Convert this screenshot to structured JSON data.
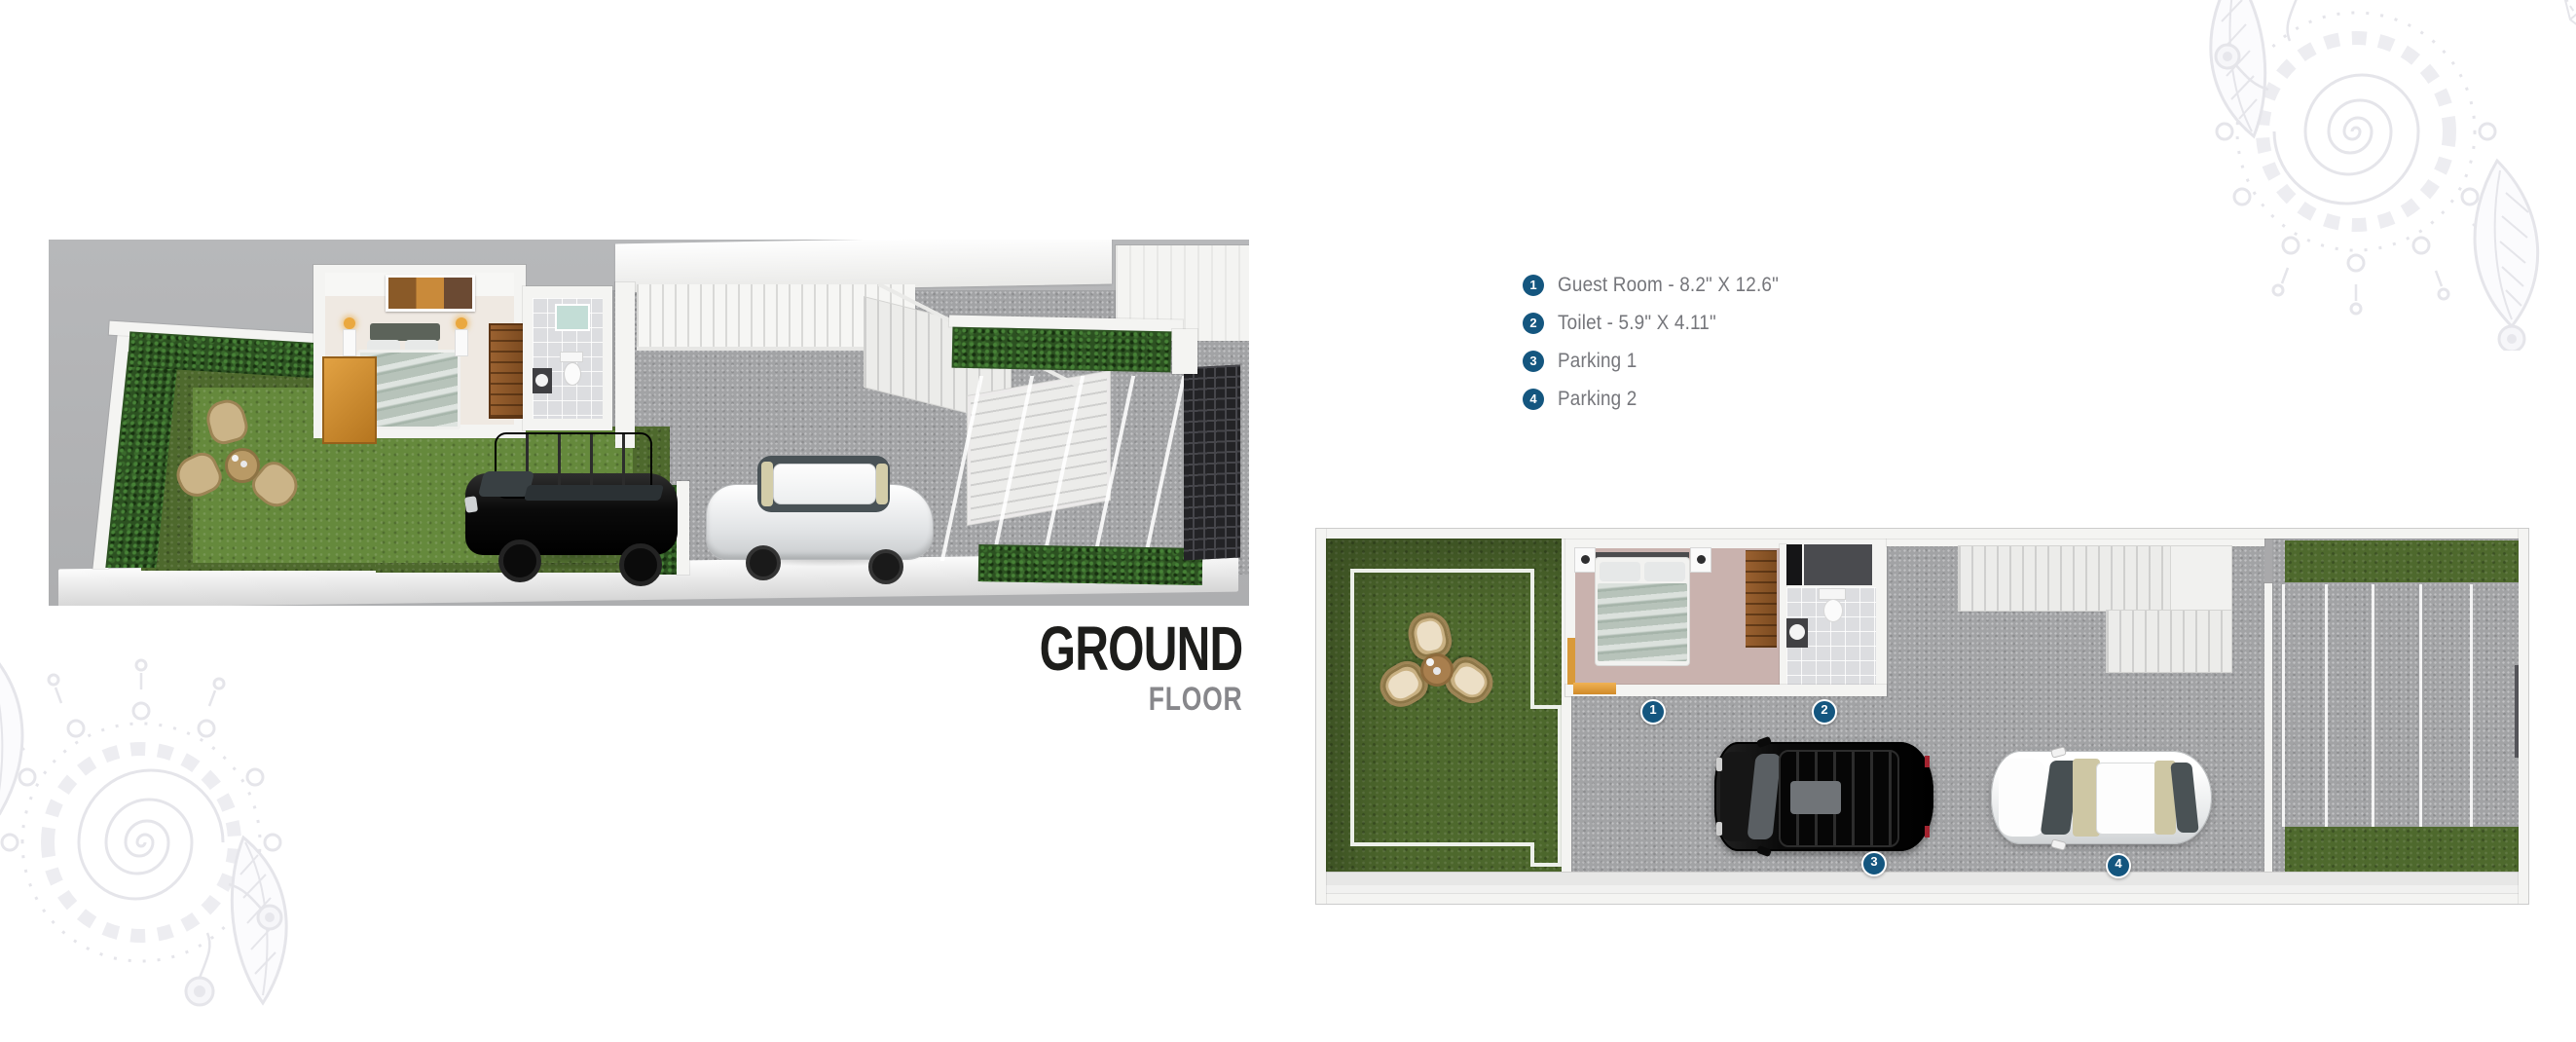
{
  "title": {
    "line1": "GROUND",
    "line2": "FLOOR"
  },
  "legend": {
    "items": [
      {
        "number": "1",
        "label": "Guest Room - 8.2\" X 12.6\""
      },
      {
        "number": "2",
        "label": "Toilet - 5.9\" X 4.11\""
      },
      {
        "number": "3",
        "label": "Parking 1"
      },
      {
        "number": "4",
        "label": "Parking 2"
      }
    ]
  },
  "plans": {
    "iso_view": {
      "markers_visible": ""
    },
    "top_view": {
      "markers_visible": "1 2 3 4"
    }
  },
  "colors": {
    "marker_blue": "#14567f",
    "title_black": "#1d1d1b",
    "title_gray": "#87878b",
    "legend_text": "#75767b",
    "pave": "#a2a3a5",
    "grass_dark": "#4e692d",
    "grass_light": "#65893c",
    "hedge": "#2c5121",
    "wood": "#8a5529",
    "bedroom_floor": "#c9b2ae",
    "duvet": "#b7c3ba",
    "gate": "#232326",
    "wall": "#f4f4f2"
  }
}
